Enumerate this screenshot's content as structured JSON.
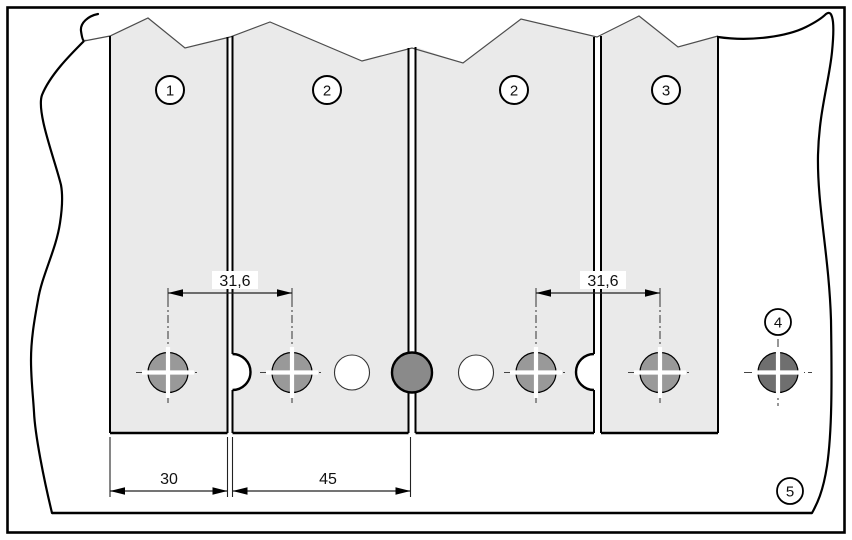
{
  "figure": {
    "callouts": [
      {
        "label": "1"
      },
      {
        "label": "2"
      },
      {
        "label": "2"
      },
      {
        "label": "3"
      },
      {
        "label": "4"
      },
      {
        "label": "5"
      }
    ],
    "dimensions": {
      "pitch_left": "31,6",
      "pitch_right": "31,6",
      "width_panel_1": "30",
      "width_panel_2": "45"
    },
    "colors": {
      "panel_fill": "#eaeaea",
      "screw_hole_gray": "#999999",
      "joint_hole_gray": "#8a8a8a",
      "base_hole_gray": "#6f6f6f",
      "clearance_hole_fill": "#ffffff",
      "line": "#000000"
    }
  }
}
